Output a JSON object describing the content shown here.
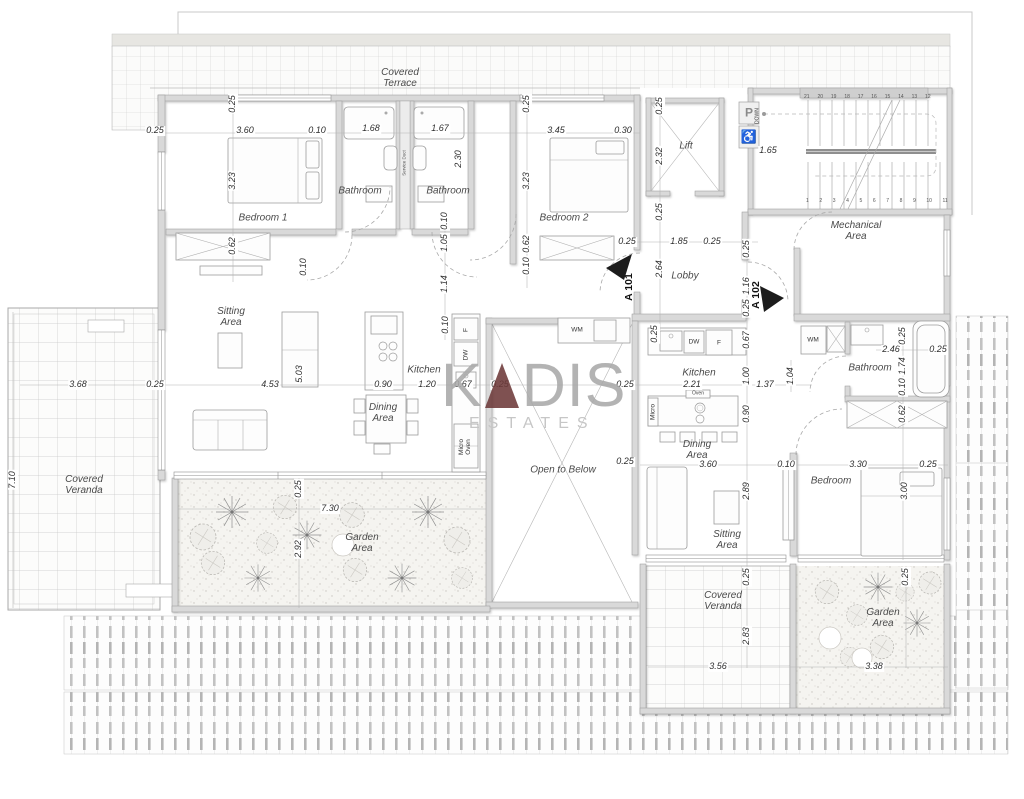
{
  "watermark": {
    "part1": "K",
    "part2": "DIS",
    "tagline": "ESTATES",
    "accent": "#6E3A3A",
    "letter_gray": "#A9A9A9"
  },
  "rooms": {
    "terrace": "Covered Terrace",
    "bedroom1": "Bedroom 1",
    "bath_a": "Bathroom",
    "bath_b": "Bathroom",
    "bath_c": "Bathroom",
    "service_duct": "Service Duct",
    "bedroom2": "Bedroom 2",
    "lift": "Lift",
    "down": "DOWN",
    "mechanical": "Mechanical Area",
    "lobby": "Lobby",
    "a101": "A 101",
    "a102": "A 102",
    "sitting1": "Sitting Area",
    "sitting2": "Sitting Area",
    "kitchen1": "Kitchen",
    "kitchen2": "Kitchen",
    "dining1": "Dining Area",
    "dining2": "Dining Area",
    "open_below": "Open to Below",
    "bedroom3": "Bedroom",
    "veranda_left": "Covered Veranda",
    "veranda_right": "Covered Veranda",
    "garden_left": "Garden Area",
    "garden_right": "Garden Area",
    "wm1": "WM",
    "wm2": "WM",
    "f1": "F",
    "f2": "F",
    "dw1": "DW",
    "dw2": "DW",
    "micro_oven1": "Micro Oven",
    "micro2": "Micro",
    "oven2": "Oven",
    "p_sign": "P",
    "accessible_sign": "♿"
  },
  "stairs": {
    "top_numbers": "21 20 19 18 17 16 15 14 13 12",
    "bottom_numbers": "1 2 3 4 5 6 7 8 9 10 11"
  },
  "dims": {
    "d01": "0.25",
    "d02": "3.60",
    "d03": "0.10",
    "d04": "1.68",
    "d05": "1.67",
    "d06": "3.45",
    "d07": "0.30",
    "d08": "1.65",
    "d09": "0.25",
    "d10": "3.23",
    "d11": "0.62",
    "d12": "0.10",
    "d13": "2.30",
    "d14": "0.10",
    "d15": "1.05",
    "d16": "1.14",
    "d17": "0.25",
    "d18": "3.23",
    "d19": "0.62",
    "d20": "0.10",
    "d21": "0.25",
    "d22": "2.32",
    "d23": "0.25",
    "d24": "2.64",
    "d25": "0.25",
    "d26": "1.85",
    "d27": "0.25",
    "d28": "0.25",
    "d29": "1.16",
    "d30": "0.25",
    "d31": "3.68",
    "d32": "0.25",
    "d33": "4.53",
    "d34": "5.03",
    "d35": "0.90",
    "d36": "1.20",
    "d37": "0.67",
    "d38": "0.25",
    "d39": "0.25",
    "d40": "0.10",
    "d41": "7.10",
    "d42": "0.25",
    "d43": "0.25",
    "d44": "0.67",
    "d45": "1.00",
    "d46": "0.90",
    "d47": "2.21",
    "d48": "1.37",
    "d49": "1.04",
    "d50": "2.46",
    "d51": "0.25",
    "d52": "0.25",
    "d53": "1.74",
    "d54": "0.10",
    "d55": "0.62",
    "d56": "3.00",
    "d57": "3.60",
    "d58": "0.10",
    "d59": "3.30",
    "d60": "0.25",
    "d61": "2.89",
    "d62": "0.25",
    "d63": "7.30",
    "d64": "2.92",
    "d65": "0.25",
    "d66": "2.83",
    "d67": "3.56",
    "d68": "0.25",
    "d69": "3.38"
  }
}
